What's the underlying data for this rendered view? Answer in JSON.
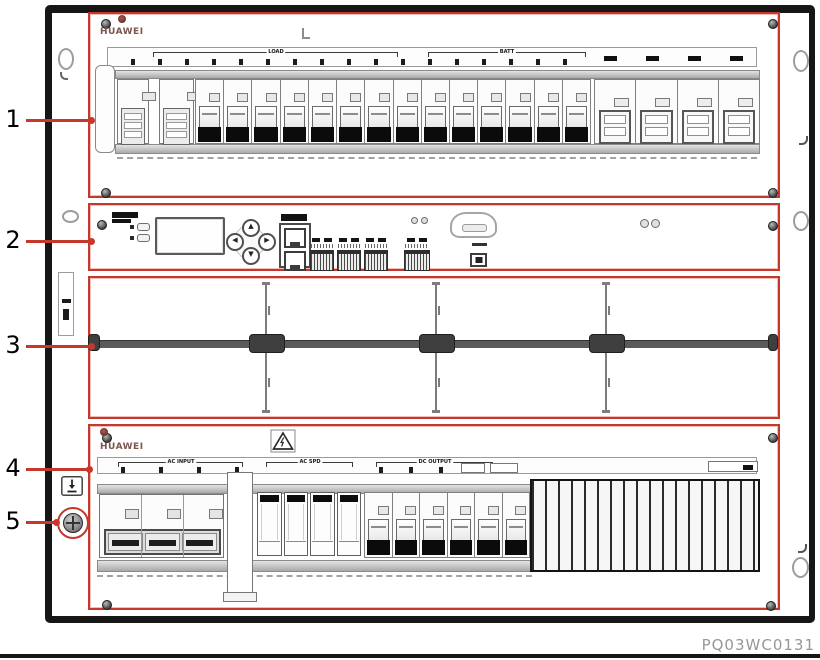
{
  "figure": {
    "code": "PQ03WC0131"
  },
  "colors": {
    "highlight_red": "#c4392c"
  },
  "callouts": {
    "items": [
      {
        "n": "1"
      },
      {
        "n": "2"
      },
      {
        "n": "3"
      },
      {
        "n": "4"
      },
      {
        "n": "5"
      }
    ]
  },
  "dc_panel": {
    "brand": "HUAWEI",
    "strip": {
      "bracket_left": "LOAD",
      "bracket_right": "BATT",
      "ticks": 17,
      "right_labels": 4
    },
    "breakers": {
      "large_left": 2,
      "small": 14,
      "large_right": 4
    }
  },
  "smu_panel": {
    "leds": 2,
    "keypad_keys": [
      "▲",
      "◀",
      "▶",
      "▼"
    ],
    "lan_ports": 2,
    "terminal_groups": 3
  },
  "rectifier_bay": {
    "slots": 4
  },
  "ac_panel": {
    "brand": "HUAWEI",
    "strip": {
      "brackets": [
        "AC INPUT",
        "AC SPD",
        "DC OUTPUT"
      ],
      "left_ticks": 4,
      "right_ticks": 4
    },
    "ac_breaker_poles": 3,
    "spd_modules": 4,
    "dc_breakers": 6
  }
}
